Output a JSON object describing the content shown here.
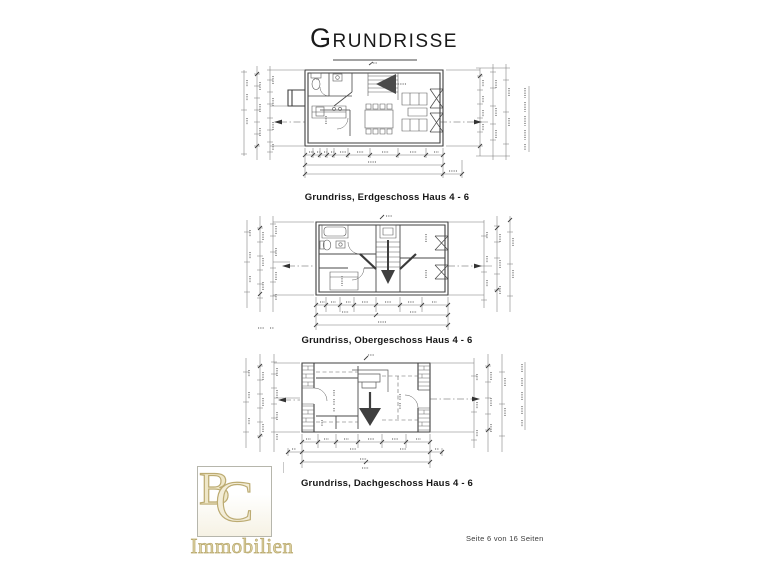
{
  "page": {
    "title": "Grundrisse",
    "footer": "Seite 6 von 16 Seiten"
  },
  "plans": [
    {
      "caption": "Grundriss, Erdgeschoss  Haus 4 - 6"
    },
    {
      "caption": "Grundriss, Obergeschoss Haus 4 - 6"
    },
    {
      "caption": "Grundriss, Dachgeschoss Haus 4 - 6"
    }
  ],
  "logo": {
    "initial_b": "B",
    "initial_c": "C",
    "wordmark": "Immobilien",
    "gold_color": "#bcab72"
  },
  "colors": {
    "ink": "#3f3f3f",
    "dimension_lines": "#787878",
    "caption_text": "#161616"
  }
}
